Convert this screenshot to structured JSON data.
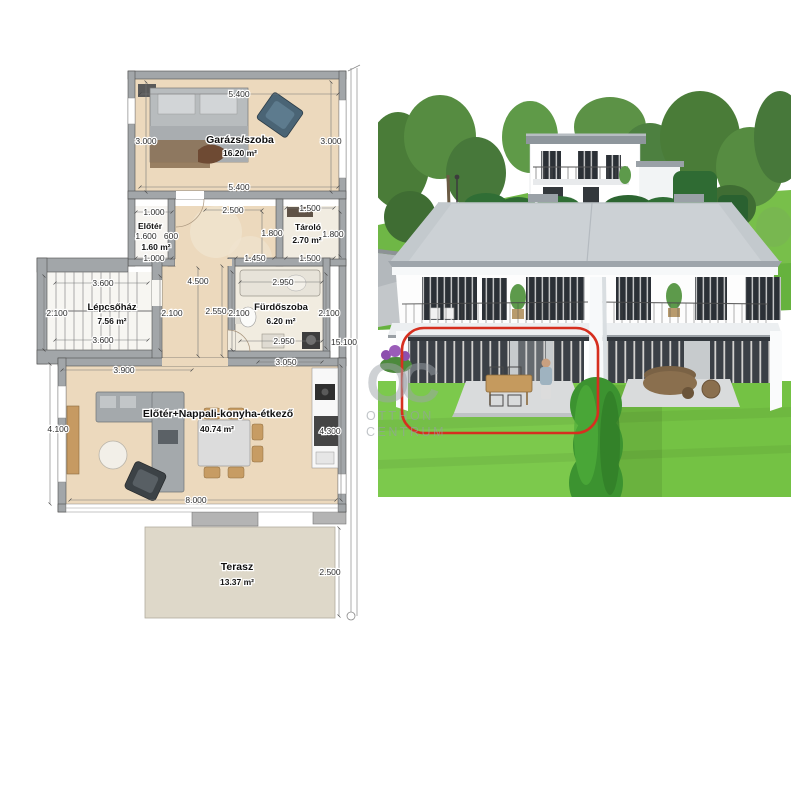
{
  "floorplan": {
    "rooms": {
      "garage": {
        "name": "Garázs/szoba",
        "area": "16.20 m²"
      },
      "eloter": {
        "name": "Előtér",
        "area": "1.60 m²"
      },
      "tarolo": {
        "name": "Tároló",
        "area": "2.70 m²"
      },
      "stairwell": {
        "name": "Lépcsőház",
        "area": "7.56 m²"
      },
      "bathroom": {
        "name": "Fürdőszoba",
        "area": "6.20 m²"
      },
      "living": {
        "name": "Előtér+Nappali-konyha-étkező",
        "area": "40.74 m²"
      },
      "terrace": {
        "name": "Terasz",
        "area": "13.37 m²"
      }
    },
    "dims": {
      "garage_top": "5.400",
      "garage_left": "3.000",
      "garage_right": "3.000",
      "garage_bottom": "5.400",
      "eloter_top": "1.000",
      "hall_top": "2.500",
      "tarolo_top": "1.500",
      "eloter_w": "1.600",
      "eloter_w2": "600",
      "tarolo_left": "1.800",
      "tarolo_right": "1.800",
      "eloter_bottom": "1.000",
      "hall_bottom": "1.450",
      "tarolo_bottom": "1.500",
      "stair_top": "3.600",
      "stair_left": "2.100",
      "stair_right": "2.100",
      "stair_bottom": "3.600",
      "corridor_h": "4.500",
      "bath_outer": "2.550",
      "bath_left": "2.100",
      "bath_top": "2.950",
      "bath_right": "2.100",
      "bath_bottom": "2.950",
      "total_height": "15.100",
      "living_topright": "3.050",
      "living_topleft": "3.900",
      "living_left": "4.100",
      "living_right": "4.300",
      "living_bottom": "8.000",
      "terrace_right": "2.500"
    }
  },
  "photo": {
    "annotation_color": "#d62f1f"
  },
  "colors": {
    "wall_gray": "#a2a6a9",
    "wood_floor": "#ecd9bd",
    "terrace_slab": "#ded8c9",
    "grass": "#7cc94c",
    "hedge": "#2e6b33",
    "roof": "#ccd1d5",
    "annotation_red": "#d62f1f"
  },
  "watermark": {
    "logo": "OC",
    "line1": "OTTHON",
    "line2": "CENTRUM"
  }
}
